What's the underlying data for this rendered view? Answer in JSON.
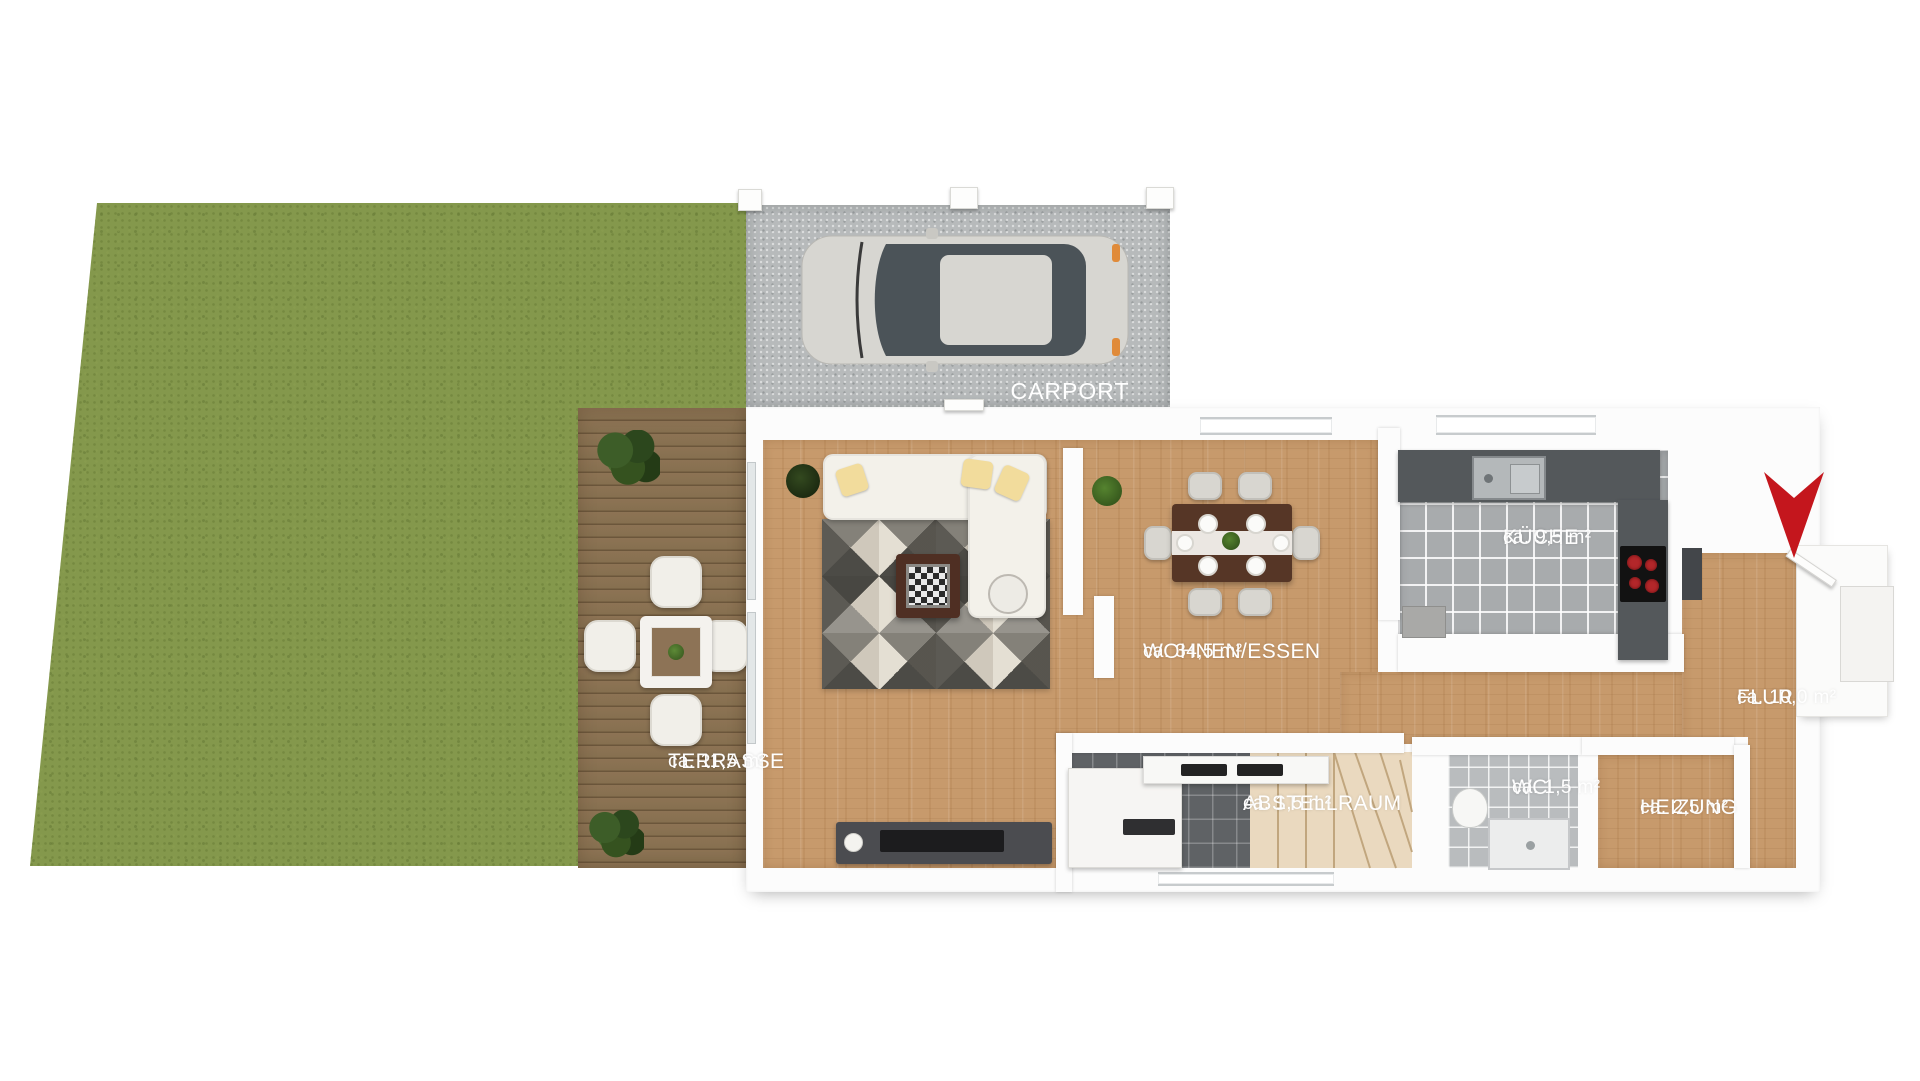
{
  "plan": {
    "carport": {
      "label": "CARPORT"
    },
    "rooms": {
      "terrasse": {
        "name": "TERRASSE",
        "area": "ca. 11,5 m²"
      },
      "wohnen_essen": {
        "name": "WOHNEN/ESSEN",
        "area": "ca. 34,5 m²"
      },
      "kueche": {
        "name": "KÜCHE",
        "area": "ca. 9,5 m²"
      },
      "flur": {
        "name": "FLUR",
        "area": "ca. 10,0 m²"
      },
      "wc": {
        "name": "WC",
        "area": "ca. 1,5 m²"
      },
      "heizung": {
        "name": "HEIZUNG",
        "area": "ca. 2,5 m²"
      },
      "abstellraum": {
        "name": "ABSTELLRAUM",
        "area": "ca. 1,5 m²"
      }
    },
    "icons": {
      "entrance_marker": "red-arrow-down"
    },
    "colors": {
      "lawn": "#84984c",
      "terrace_wood": "#8b7254",
      "interior_wood": "#c79a6c",
      "kitchen_tile": "#a8abad",
      "storage_tile": "#5f6265",
      "wc_tile": "#b9bcbe",
      "carport_concrete": "#b7babb",
      "wall": "#fcfcfc",
      "entrance_arrow": "#c4161d",
      "label_text": "#ffffff"
    }
  }
}
